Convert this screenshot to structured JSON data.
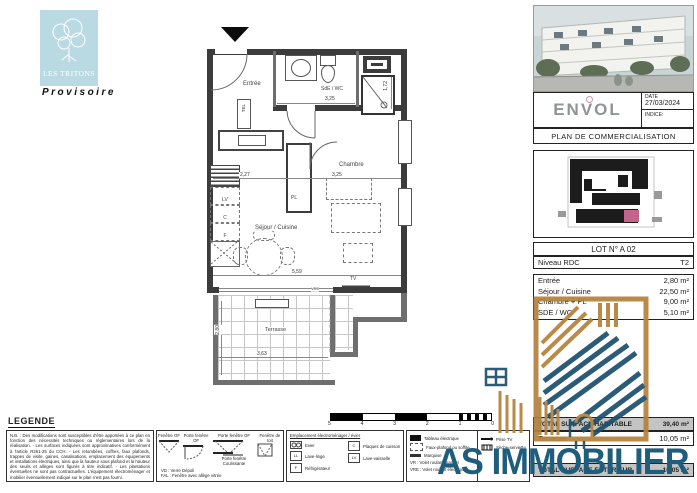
{
  "branding": {
    "estate": "LES TRITONS",
    "status": "Provisoire",
    "developer": "ENVOL"
  },
  "title_block": {
    "date_label": "DATE",
    "date_value": "27/03/2024",
    "indice_label": "INDICE:",
    "plan_title": "PLAN DE COMMERCIALISATION"
  },
  "lot": {
    "number": "LOT N° A 02",
    "level": "Niveau RDC",
    "type": "T2"
  },
  "surfaces": {
    "rows": [
      {
        "label": "Entrée",
        "value": "2,80 m²"
      },
      {
        "label": "Séjour / Cuisine",
        "value": "22,50 m²"
      },
      {
        "label": "Chambre + PL",
        "value": "9,00 m²"
      },
      {
        "label": "SDE / WC",
        "value": "5,10 m²"
      }
    ],
    "total_habitable_label": "TOTAL SURFACE HABITABLE",
    "total_habitable_value": "39,40 m²",
    "terrasse_label": "Terrasse",
    "terrasse_value": "10,05 m²",
    "total_exterieur_label": "TOTAL SURFACE EXTERIEUR",
    "total_exterieur_value": "10,05 m²"
  },
  "plan": {
    "rooms": {
      "entree": "Entrée",
      "sde": "SdE / WC",
      "chambre": "Chambre",
      "pl": "PL",
      "sejour": "Séjour / Cuisine",
      "terrasse": "Terrasse"
    },
    "labels": {
      "tel": "TEL",
      "lv": "LV",
      "c": "C",
      "f": "F",
      "tv": "TV",
      "vre": "VRE"
    },
    "dims": {
      "entree_w": "2,27",
      "chambre_w": "3,25",
      "sde_w": "3,25",
      "sde_d": "1,72",
      "sejour_w": "5,59",
      "terrasse_w": "3,63",
      "terrasse_d": "2,80"
    }
  },
  "legend": {
    "title": "LEGENDE",
    "nb_text": "N.B. : Des modifications sont susceptibles d'être apportées à ce plan en fonction des nécessités techniques ou réglementaires lors de la réalisation. - Les surfaces indiquées sont approximatives conformément à l'article R261-25 du CCH. - Les retombées, coffres, faux plafonds, trappes de visite, gaines, canalisations, emplacement des équipements et installations électriques, ainsi que la hauteur sous plafond et la hauteur des seuils et allèges sont figurés à titre indicatif. - Les plantations éventuelles ne sont pas contractuelles. L'équipement électroménager et mobilier éventuellement indiqué sur le plan n'est pas fourni.",
    "windows": {
      "items": [
        "Fenêtre OF",
        "Porte fenêtre OF",
        "Porte fenêtre OF",
        "Fenêtre de toit"
      ],
      "sliding": "Porte fenêtre Coulissante",
      "notes": [
        "VD : Verre Dépoli",
        "FAL : Fenêtre avec allège vitrée"
      ]
    },
    "appliances": {
      "title": "Emplacement électroménager / évier",
      "items": [
        "Evier",
        "Lave-linge",
        "Plaques de cuisson",
        "Réfrigérateur",
        "Lave-vaisselle"
      ]
    },
    "electrical": {
      "items": [
        "Tableau électrique",
        "Faux-plafond ou soffite",
        "Marquise",
        "VR : Volet roulant manuel",
        "VRE : Volet roulant électrique"
      ]
    },
    "outlets": {
      "items": [
        "Prise TV",
        "Sèche-serviette"
      ]
    },
    "scale_numbers": [
      "5",
      "4",
      "3",
      "2",
      "1",
      "0"
    ]
  },
  "watermark": {
    "text": "AS IMMOBILIER 7"
  },
  "colors": {
    "logo_blue": "#b9dae3",
    "wall_gray": "#3c3c3c",
    "watermark_blue": "#1e5e7c",
    "watermark_gold": "#b5823c",
    "lot_pink": "#c4648c",
    "band_gray": "#c4c4c4"
  }
}
